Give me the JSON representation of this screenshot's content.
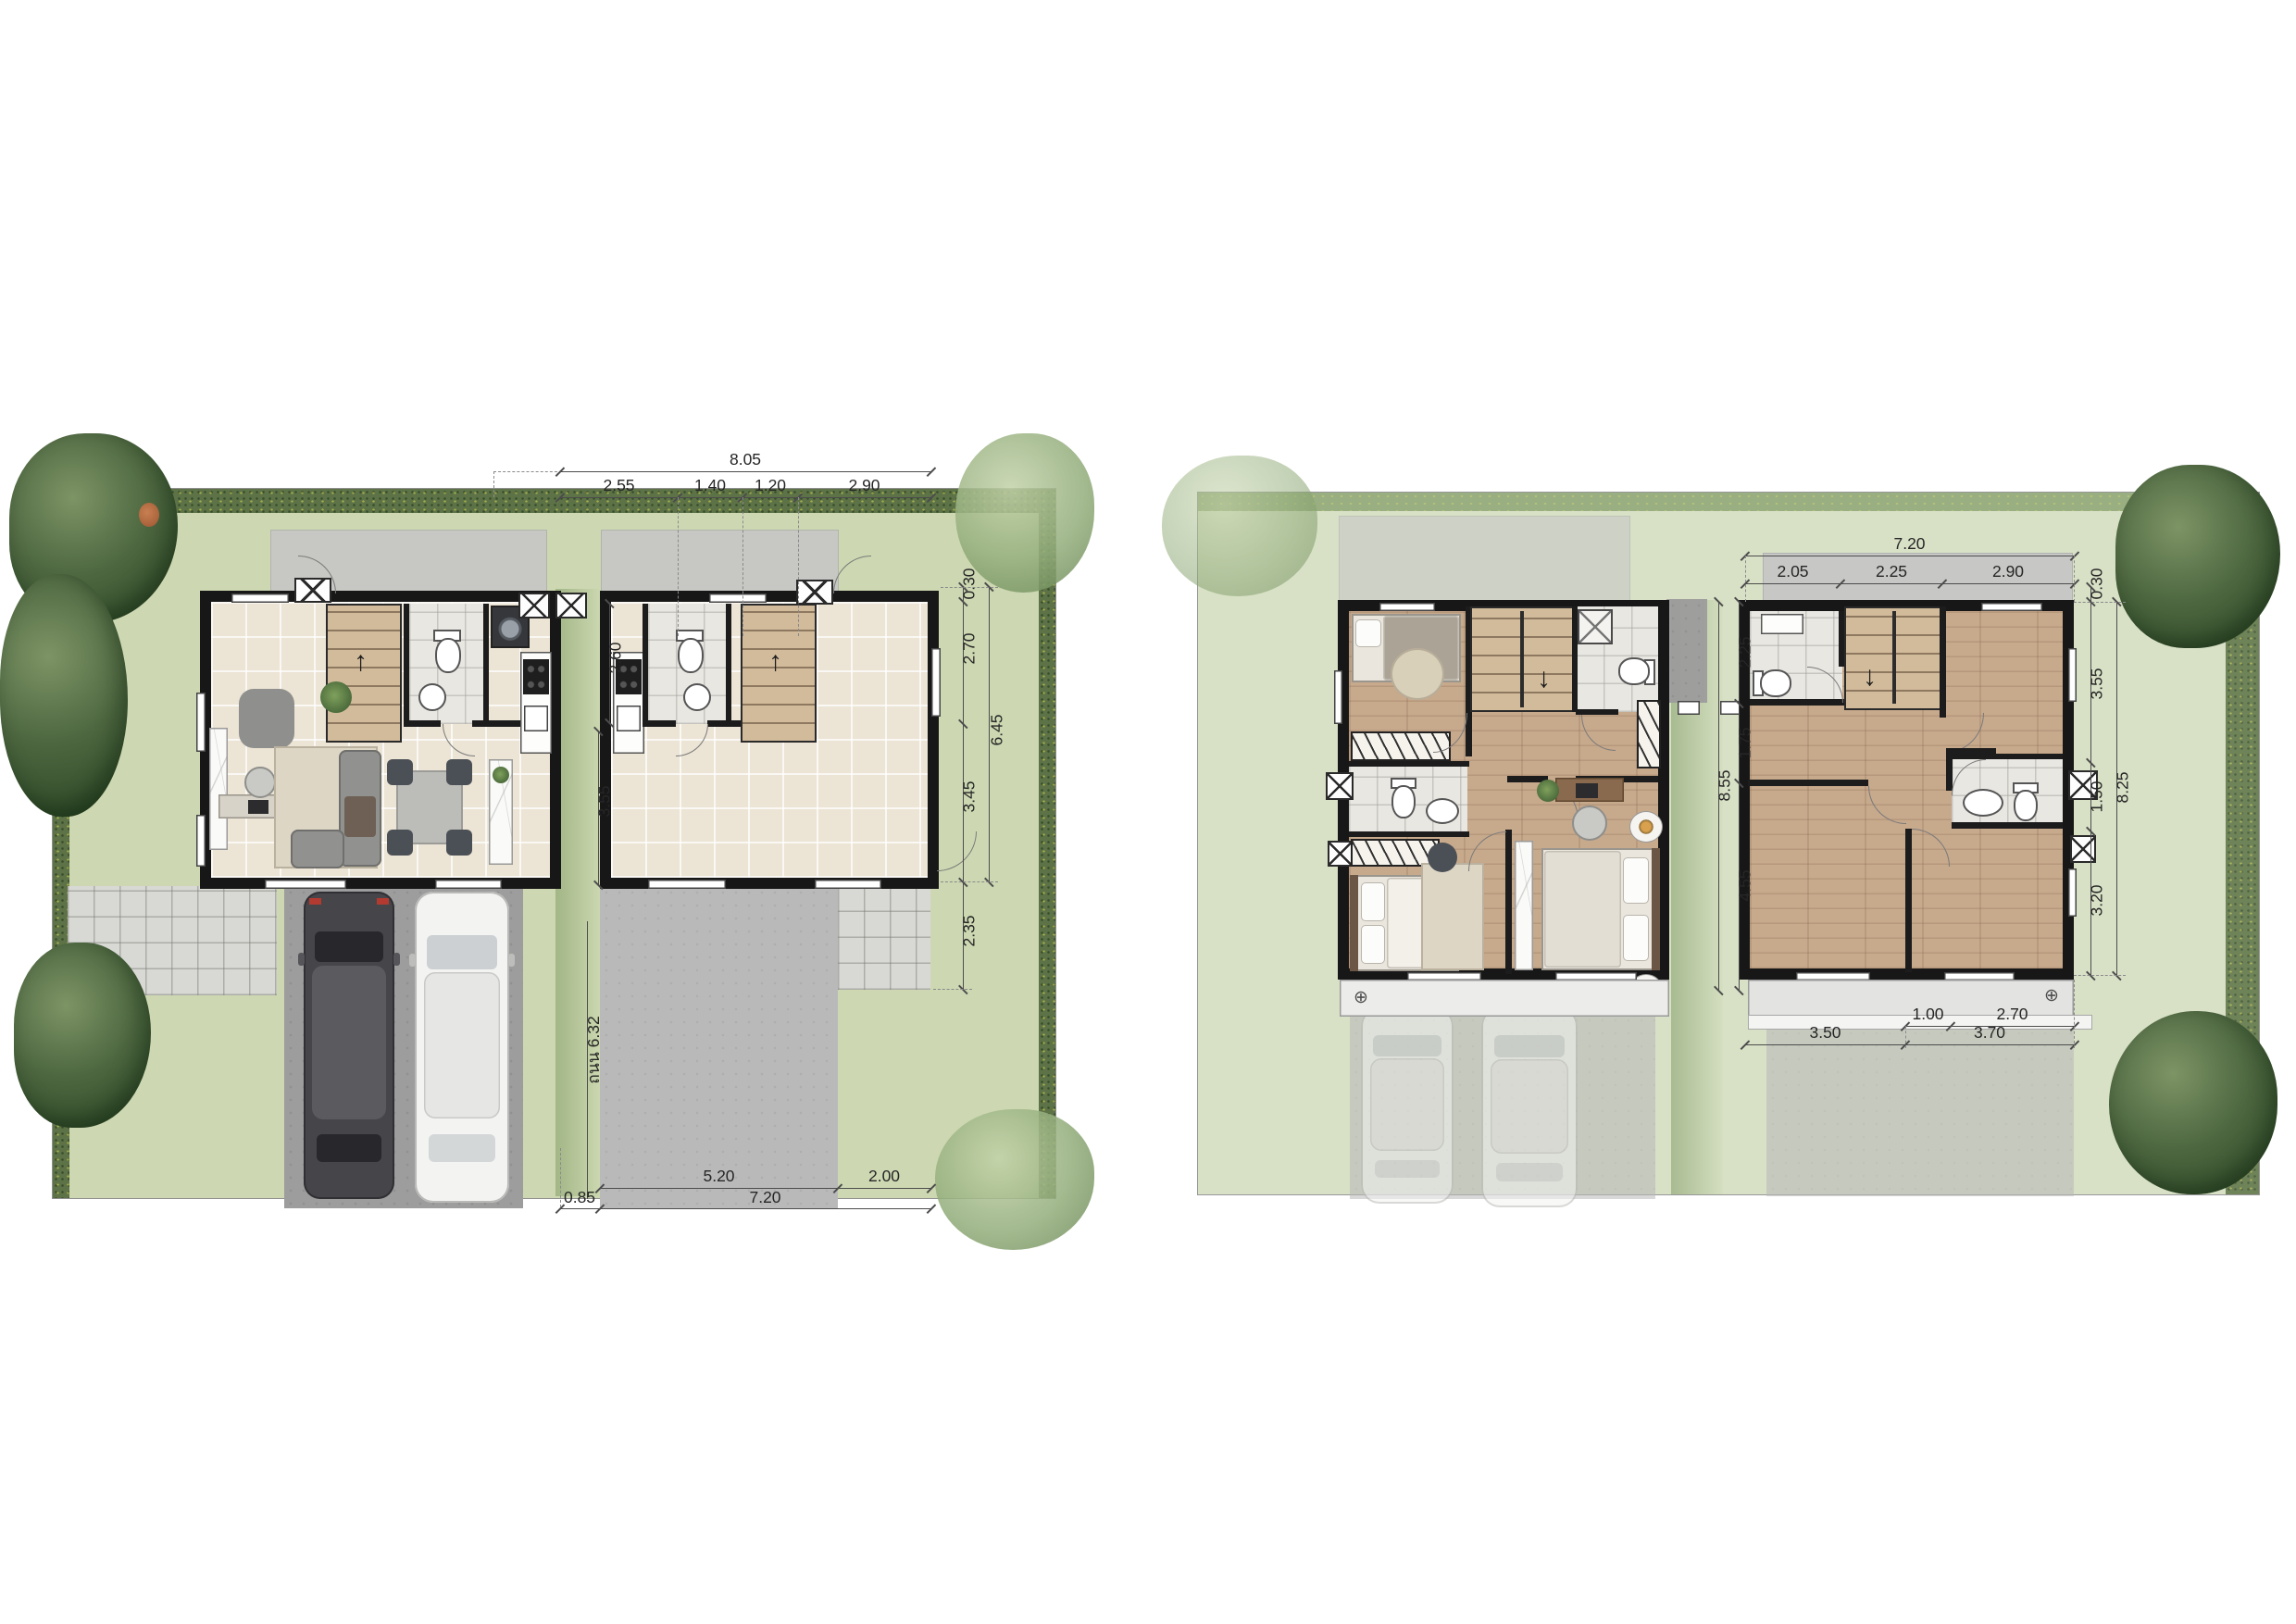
{
  "document": {
    "type": "twin-house floor plan rendering",
    "sheets": [
      "first-floor-site-plan",
      "second-floor-site-plan"
    ]
  },
  "palette": {
    "lawn_left": "#cdd8b2",
    "lawn_right": "#d8e1c6",
    "hedge": "#5d7347",
    "wall": "#171717",
    "tile_floor": "#ece4d4",
    "wood_floor": "#c7a98c",
    "driveway_dark": "#9d9d9d",
    "driveway_light": "#b9b9b9",
    "dim_text": "#262626"
  },
  "icons": {
    "flower_symbol": "⊕",
    "arrow_up": "↑",
    "arrow_down": "↓"
  },
  "left": {
    "top": {
      "total": "8.05",
      "s1": "2.55",
      "s2": "1.40",
      "s3": "1.20",
      "s4": "2.90"
    },
    "right": {
      "offset": "0.30",
      "s1": "2.70",
      "total": "6.45",
      "s2": "3.45",
      "porch": "2.35"
    },
    "center": {
      "upper": "2.60",
      "lower": "3.55",
      "road": "ถนน 6.32"
    },
    "bottom": {
      "s1": "5.20",
      "s2": "2.00",
      "s3": "0.85",
      "total": "7.20"
    }
  },
  "right": {
    "top": {
      "total": "7.20",
      "s1": "2.05",
      "s2": "2.25",
      "s3": "2.90"
    },
    "side": {
      "offset": "0.30",
      "s1": "3.55",
      "s2": "1.50",
      "s3": "3.20",
      "total": "8.25"
    },
    "center": {
      "s1": "2.25",
      "s2": "1.75",
      "s3": "4.55",
      "total": "8.55"
    },
    "bottom": {
      "s1": "1.00",
      "s2": "2.70",
      "s3": "3.50",
      "s4": "3.70"
    }
  }
}
